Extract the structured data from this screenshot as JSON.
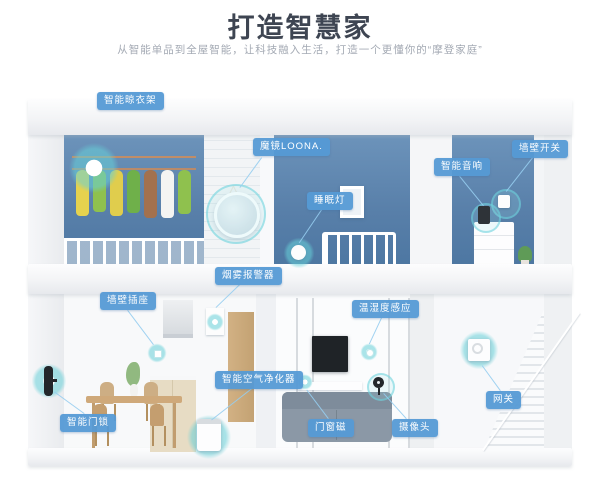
{
  "header": {
    "title": "打造智慧家",
    "subtitle": "从智能单品到全屋智能，让科技融入生活，打造一个更懂你的“摩登家庭”"
  },
  "device_labels": {
    "drying_rack": "智能晾衣架",
    "magic_mirror": "魔镜LOONA.",
    "sleep_lamp": "睡眠灯",
    "smart_speaker": "智能音响",
    "wall_switch": "墙壁开关",
    "smoke_alarm": "烟雾报警器",
    "wall_socket": "墙壁插座",
    "temp_humidity_sensor": "温湿度感应",
    "air_purifier": "智能空气净化器",
    "door_lock": "智能门锁",
    "door_window_sensor": "门窗磁",
    "camera": "摄像头",
    "gateway": "网关"
  },
  "colors": {
    "label_bg": "#559ad5",
    "accent_cyan": "#67d0d8",
    "wall_blue": "#587fa9",
    "title_text": "#3e4552",
    "subtitle_text": "#a4aab4"
  }
}
